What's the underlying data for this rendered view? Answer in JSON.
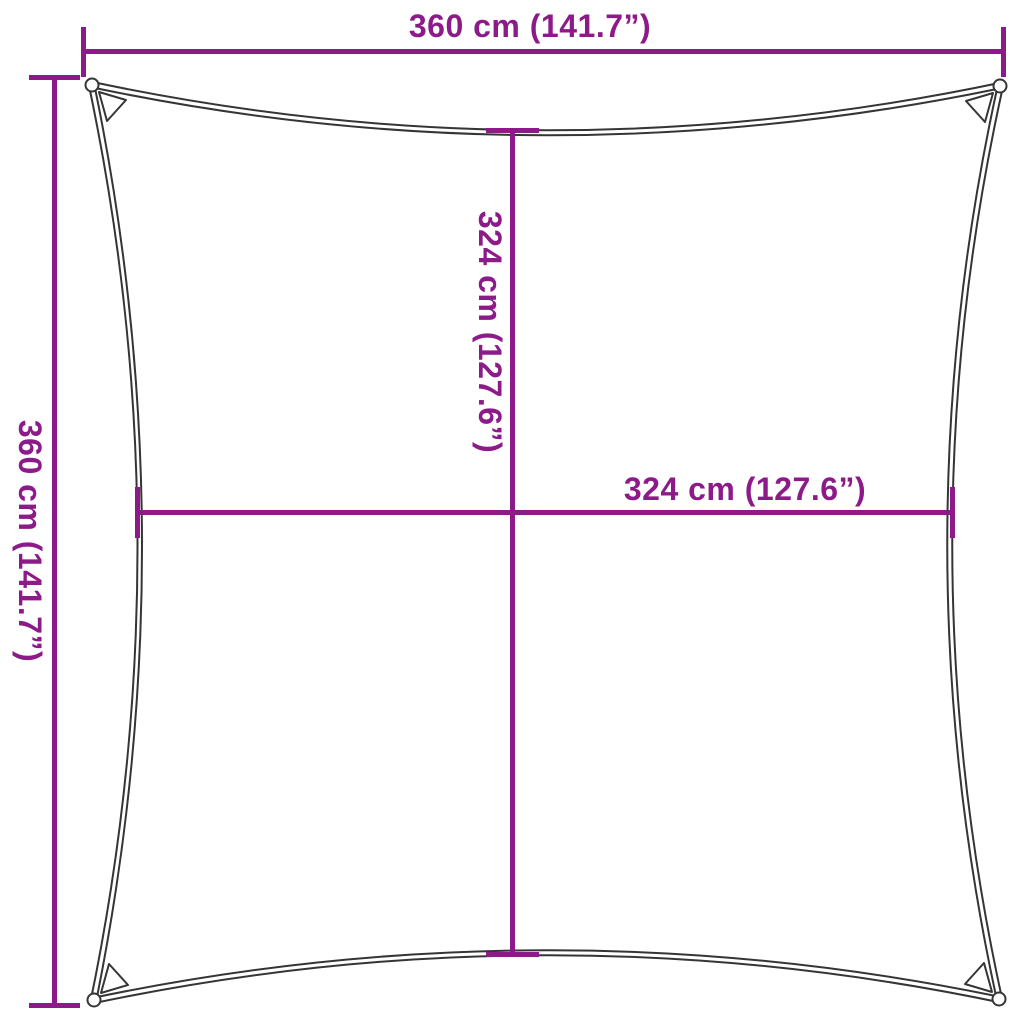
{
  "canvas": {
    "width_px": 1024,
    "height_px": 1024
  },
  "colors": {
    "dimension": "#8d1a89",
    "outline": "#353535",
    "background": "#ffffff"
  },
  "labels": {
    "top_width": "360 cm (141.7”)",
    "left_height": "360 cm (141.7”)",
    "inner_height": "324 cm (127.6”)",
    "inner_width": "324 cm (127.6”)"
  },
  "values": {
    "overall_width_cm": 360,
    "overall_width_in": 141.7,
    "overall_height_cm": 360,
    "overall_height_in": 141.7,
    "inner_width_cm": 324,
    "inner_width_in": 127.6,
    "inner_height_cm": 324,
    "inner_height_in": 127.6
  }
}
